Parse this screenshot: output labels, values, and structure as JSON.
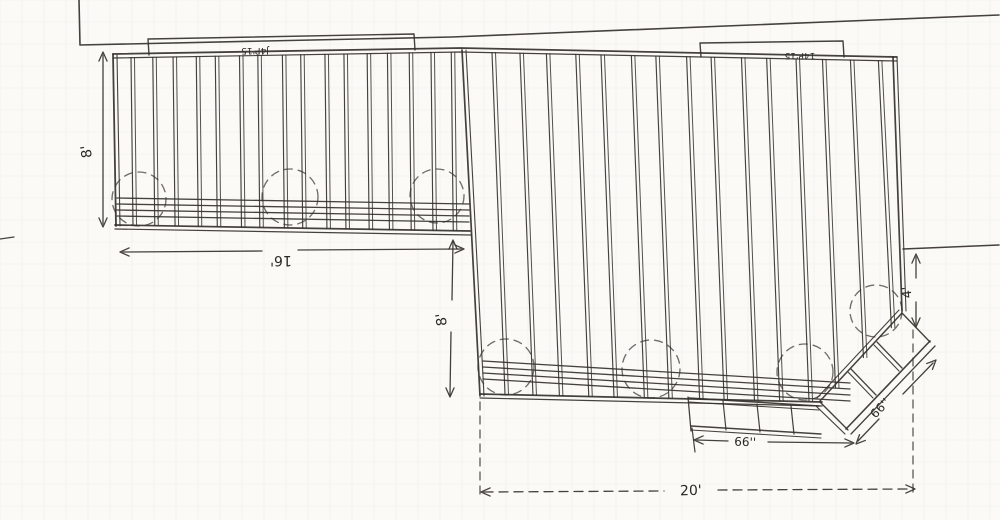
{
  "labels": {
    "dim_8_left": "8'",
    "dim_16": "16'",
    "dim_8_mid": "8'",
    "dim_4": "4'",
    "dim_20": "20'",
    "dim_66_step": "66''",
    "dim_66_diag": "66''",
    "ledger_left": "J4P'15",
    "ledger_right": "14P'15"
  },
  "colors": {
    "paper": "#fbfaf7",
    "ink": "#35322d",
    "dim": "#3a3732",
    "grid": "#9fb6c0"
  },
  "drawing": {
    "canvas": {
      "w": 1000,
      "h": 520
    },
    "grid_step": 22,
    "grid_opacity": 0.16,
    "static_lines": [
      {
        "n": "house-wall-line",
        "p": [
          [
            79,
            0
          ],
          [
            80,
            45
          ],
          [
            452,
            37
          ],
          [
            999,
            15
          ]
        ],
        "w": 1.6
      },
      {
        "n": "right-boundary-line",
        "p": [
          [
            903,
            249
          ],
          [
            999,
            245
          ]
        ],
        "w": 1.5
      },
      {
        "n": "deck-top-edge-outer",
        "p": [
          [
            113,
            54
          ],
          [
            460,
            48
          ],
          [
            897,
            57
          ]
        ],
        "w": 1.8
      },
      {
        "n": "deck-top-edge-inner",
        "p": [
          [
            113,
            58
          ],
          [
            460,
            52
          ],
          [
            897,
            61
          ]
        ],
        "w": 1.2
      },
      {
        "n": "left-edge-outer",
        "p": [
          [
            113,
            54
          ],
          [
            116,
            226
          ]
        ],
        "w": 1.8
      },
      {
        "n": "left-edge-inner",
        "p": [
          [
            117,
            55
          ],
          [
            120,
            226
          ]
        ],
        "w": 1.1
      },
      {
        "n": "left-section-bottom-outer",
        "p": [
          [
            115,
            225
          ],
          [
            470,
            231
          ]
        ],
        "w": 1.7
      },
      {
        "n": "left-section-bottom-inner",
        "p": [
          [
            115,
            229
          ],
          [
            471,
            235
          ]
        ],
        "w": 1.2
      },
      {
        "n": "right-section-left-edge-outer",
        "p": [
          [
            462,
            50
          ],
          [
            480,
            396
          ]
        ],
        "w": 1.7
      },
      {
        "n": "right-section-left-edge-inner",
        "p": [
          [
            466,
            50
          ],
          [
            484,
            396
          ]
        ],
        "w": 1.1
      },
      {
        "n": "right-section-right-edge-outer",
        "p": [
          [
            893,
            57
          ],
          [
            902,
            311
          ]
        ],
        "w": 1.7
      },
      {
        "n": "right-section-right-edge-inner",
        "p": [
          [
            897,
            57
          ],
          [
            906,
            311
          ]
        ],
        "w": 1.1
      },
      {
        "n": "right-section-bottom-outer",
        "p": [
          [
            480,
            394
          ],
          [
            822,
            402
          ]
        ],
        "w": 1.7
      },
      {
        "n": "right-section-bottom-inner",
        "p": [
          [
            480,
            398
          ],
          [
            822,
            406
          ]
        ],
        "w": 1.2
      },
      {
        "n": "diagonal-cut-outer",
        "p": [
          [
            902,
            313
          ],
          [
            820,
            401
          ]
        ],
        "w": 1.5
      },
      {
        "n": "diagonal-cut-inner",
        "p": [
          [
            899,
            310
          ],
          [
            817,
            398
          ]
        ],
        "w": 1.1
      },
      {
        "n": "ladder-outer-rail-1",
        "p": [
          [
            846,
            429
          ],
          [
            930,
            341
          ]
        ],
        "w": 1.6
      },
      {
        "n": "ladder-outer-rail-2",
        "p": [
          [
            851,
            434
          ],
          [
            935,
            346
          ]
        ],
        "w": 1.3
      },
      {
        "n": "ladder-low-cap-1",
        "p": [
          [
            820,
            402
          ],
          [
            848,
            430
          ]
        ],
        "w": 1.4
      },
      {
        "n": "ladder-low-cap-2",
        "p": [
          [
            816,
            406
          ],
          [
            845,
            434
          ]
        ],
        "w": 1.2
      },
      {
        "n": "ladder-high-cap",
        "p": [
          [
            902,
            313
          ],
          [
            930,
            342
          ]
        ],
        "w": 1.4
      },
      {
        "n": "ladder-rung-1a",
        "p": [
          [
            851,
            369
          ],
          [
            876,
            395
          ]
        ],
        "w": 1.3
      },
      {
        "n": "ladder-rung-1b",
        "p": [
          [
            848,
            372
          ],
          [
            873,
            398
          ]
        ],
        "w": 1.1
      },
      {
        "n": "ladder-rung-2a",
        "p": [
          [
            877,
            342
          ],
          [
            902,
            368
          ]
        ],
        "w": 1.3
      },
      {
        "n": "ladder-rung-2b",
        "p": [
          [
            874,
            345
          ],
          [
            899,
            371
          ]
        ],
        "w": 1.1
      },
      {
        "n": "step-top-outer",
        "p": [
          [
            689,
            398
          ],
          [
            819,
            406
          ]
        ],
        "w": 1.5
      },
      {
        "n": "step-top-inner",
        "p": [
          [
            689,
            402
          ],
          [
            819,
            410
          ]
        ],
        "w": 1.1
      },
      {
        "n": "step-bottom-outer",
        "p": [
          [
            691,
            426
          ],
          [
            821,
            434
          ]
        ],
        "w": 1.5
      },
      {
        "n": "step-bottom-inner",
        "p": [
          [
            691,
            430
          ],
          [
            821,
            438
          ]
        ],
        "w": 1.1
      },
      {
        "n": "step-left-cap",
        "p": [
          [
            688,
            397
          ],
          [
            691,
            431
          ]
        ],
        "w": 1.3
      },
      {
        "n": "step-divider-1",
        "p": [
          [
            723,
            401
          ],
          [
            726,
            430
          ]
        ],
        "w": 1.2
      },
      {
        "n": "step-divider-2",
        "p": [
          [
            757,
            404
          ],
          [
            760,
            432
          ]
        ],
        "w": 1.2
      },
      {
        "n": "step-divider-3",
        "p": [
          [
            791,
            406
          ],
          [
            794,
            434
          ]
        ],
        "w": 1.2
      },
      {
        "n": "left-beam-line-1",
        "p": [
          [
            117,
            198
          ],
          [
            469,
            204
          ]
        ],
        "w": 1.3
      },
      {
        "n": "left-beam-line-2",
        "p": [
          [
            117,
            204
          ],
          [
            469,
            210
          ]
        ],
        "w": 1.3
      },
      {
        "n": "left-beam-line-3",
        "p": [
          [
            117,
            210
          ],
          [
            469,
            216
          ]
        ],
        "w": 1.3
      },
      {
        "n": "left-beam-line-4",
        "p": [
          [
            117,
            216
          ],
          [
            469,
            222
          ]
        ],
        "w": 1.3
      },
      {
        "n": "right-beam-line-1",
        "p": [
          [
            483,
            361
          ],
          [
            850,
            383
          ]
        ],
        "w": 1.3
      },
      {
        "n": "right-beam-line-2",
        "p": [
          [
            483,
            367
          ],
          [
            850,
            389
          ]
        ],
        "w": 1.3
      },
      {
        "n": "right-beam-line-3",
        "p": [
          [
            483,
            373
          ],
          [
            850,
            395
          ]
        ],
        "w": 1.3
      },
      {
        "n": "right-beam-line-4",
        "p": [
          [
            483,
            379
          ],
          [
            850,
            401
          ]
        ],
        "w": 1.3
      },
      {
        "n": "ledger-box-left",
        "p": [
          [
            149,
            55
          ],
          [
            148,
            39
          ],
          [
            414,
            34
          ],
          [
            415,
            50
          ]
        ],
        "w": 1.4
      },
      {
        "n": "ledger-box-right",
        "p": [
          [
            701,
            57
          ],
          [
            700,
            43
          ],
          [
            843,
            41
          ],
          [
            844,
            57
          ]
        ],
        "w": 1.4
      },
      {
        "n": "step-dim-tick",
        "p": [
          [
            692,
            428
          ],
          [
            695,
            452
          ]
        ],
        "w": 1.2
      },
      {
        "n": "margin-tick",
        "p": [
          [
            0,
            239
          ],
          [
            14,
            237
          ]
        ],
        "w": 1.2
      }
    ],
    "dashed_lines": [
      {
        "n": "dashed-connector-left",
        "p": [
          [
            480,
            402
          ],
          [
            480,
            498
          ]
        ],
        "w": 1.3
      },
      {
        "n": "dashed-connector-right",
        "p": [
          [
            913,
            330
          ],
          [
            913,
            497
          ]
        ],
        "w": 1.3
      }
    ],
    "footing_circles": [
      {
        "n": "footing-circle",
        "cx": 139,
        "cy": 199,
        "r": 27
      },
      {
        "n": "footing-circle",
        "cx": 290,
        "cy": 197,
        "r": 28
      },
      {
        "n": "footing-circle",
        "cx": 437,
        "cy": 196,
        "r": 27
      },
      {
        "n": "footing-circle",
        "cx": 506,
        "cy": 367,
        "r": 28
      },
      {
        "n": "footing-circle",
        "cx": 651,
        "cy": 369,
        "r": 29
      },
      {
        "n": "footing-circle",
        "cx": 805,
        "cy": 372,
        "r": 28
      },
      {
        "n": "footing-circle-corner",
        "cx": 876,
        "cy": 311,
        "r": 26
      }
    ],
    "joist_sections": [
      {
        "n": "left-section-joists",
        "count": 16,
        "x_start": 131,
        "x_end": 452,
        "slant": 2,
        "top": [
          113,
          58,
          460,
          52
        ],
        "bottom": [
          115,
          225,
          470,
          231
        ]
      },
      {
        "n": "right-section-joists",
        "count": 15,
        "x_start": 492,
        "x_end": 878,
        "slant": 13,
        "top": [
          460,
          52,
          897,
          61
        ],
        "bottom": [
          480,
          394,
          822,
          402
        ],
        "diag": [
          822,
          402,
          906,
          312
        ]
      }
    ],
    "dimensions": [
      {
        "n": "dim-8ft-left",
        "segs": [
          [
            [
              103,
              55
            ],
            [
              103,
              224
            ]
          ]
        ],
        "arrows": [
          [
            103,
            52,
            -90
          ],
          [
            103,
            227,
            90
          ]
        ]
      },
      {
        "n": "dim-16ft",
        "segs": [
          [
            [
              123,
              252
            ],
            [
              262,
              251
            ]
          ],
          [
            [
              298,
              250
            ],
            [
              461,
              249
            ]
          ]
        ],
        "arrows": [
          [
            120,
            252,
            180
          ],
          [
            464,
            249,
            0
          ]
        ]
      },
      {
        "n": "dim-8ft-mid",
        "segs": [
          [
            [
              453,
              242
            ],
            [
              452,
              300
            ]
          ],
          [
            [
              451,
              332
            ],
            [
              450,
              395
            ]
          ]
        ],
        "arrows": [
          [
            453,
            240,
            -90
          ],
          [
            450,
            397,
            90
          ]
        ]
      },
      {
        "n": "dim-4ft",
        "segs": [
          [
            [
              916,
              257
            ],
            [
              916,
              278
            ]
          ],
          [
            [
              916,
              302
            ],
            [
              916,
              324
            ]
          ]
        ],
        "arrows": [
          [
            916,
            254,
            -90
          ],
          [
            916,
            327,
            90
          ]
        ]
      },
      {
        "n": "dim-20ft",
        "dash": "9 6",
        "segs": [
          [
            [
              484,
              492
            ],
            [
              664,
              491
            ]
          ],
          [
            [
              718,
              490
            ],
            [
              912,
              489
            ]
          ]
        ],
        "arrows": [
          [
            481,
            492,
            180
          ],
          [
            915,
            489,
            0
          ]
        ]
      },
      {
        "n": "dim-66in-step",
        "segs": [
          [
            [
              697,
              440
            ],
            [
              728,
              441
            ]
          ],
          [
            [
              768,
              442
            ],
            [
              851,
              443
            ]
          ]
        ],
        "arrows": [
          [
            694,
            440,
            180
          ],
          [
            854,
            443,
            0
          ]
        ]
      },
      {
        "n": "dim-66in-diag",
        "segs": [
          [
            [
              858,
              441
            ],
            [
              879,
              419
            ]
          ],
          [
            [
              903,
              394
            ],
            [
              933,
              363
            ]
          ]
        ],
        "arrows": [
          [
            856,
            444,
            135
          ],
          [
            936,
            360,
            -45
          ]
        ]
      }
    ],
    "texts": [
      {
        "n": "dim-8ft-left-label",
        "bind": "labels.dim_8_left",
        "x": 91,
        "y": 151,
        "rot": -98,
        "size": 14
      },
      {
        "n": "dim-16ft-label",
        "bind": "labels.dim_16",
        "x": 281,
        "y": 256,
        "rot": 180,
        "size": 14
      },
      {
        "n": "dim-8ft-mid-label",
        "bind": "labels.dim_8_mid",
        "x": 446,
        "y": 319,
        "rot": -98,
        "size": 14
      },
      {
        "n": "dim-4ft-label",
        "bind": "labels.dim_4",
        "x": 911,
        "y": 292,
        "rot": -96,
        "size": 13
      },
      {
        "n": "dim-20ft-label",
        "bind": "labels.dim_20",
        "x": 691,
        "y": 495,
        "rot": -2,
        "size": 14
      },
      {
        "n": "dim-66in-step-label",
        "bind": "labels.dim_66_step",
        "x": 745,
        "y": 446,
        "rot": 2,
        "size": 12
      },
      {
        "n": "dim-66in-diag-label",
        "bind": "labels.dim_66_diag",
        "x": 883,
        "y": 411,
        "rot": -46,
        "size": 12
      },
      {
        "n": "ledger-left-label",
        "bind": "labels.ledger_left",
        "x": 255,
        "y": 48,
        "rot": 180,
        "size": 9
      },
      {
        "n": "ledger-right-label",
        "bind": "labels.ledger_right",
        "x": 800,
        "y": 53,
        "rot": 180,
        "size": 9
      }
    ]
  }
}
